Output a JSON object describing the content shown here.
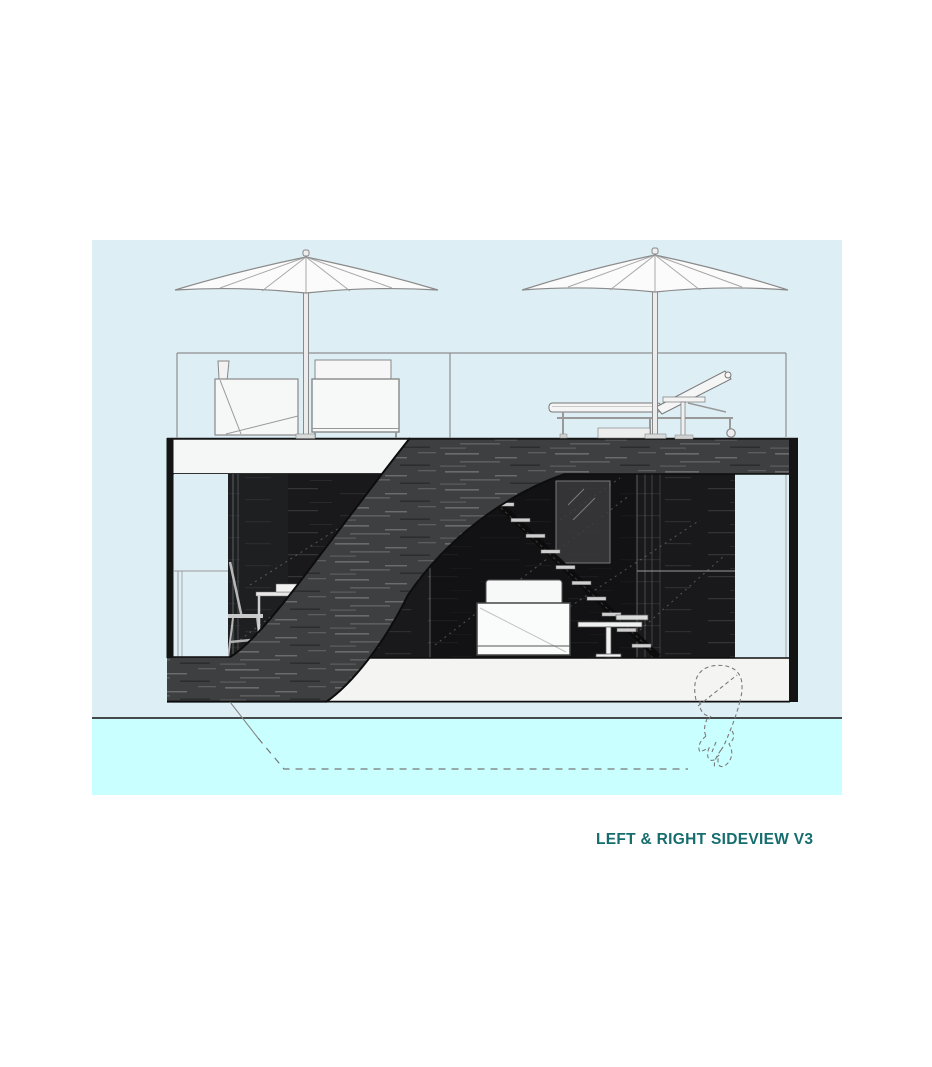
{
  "caption": {
    "text": "LEFT & RIGHT SIDEVIEW V3",
    "color": "#156d6e"
  },
  "scene": {
    "page_background": "#ffffff",
    "sky_color": "#ddeef5",
    "water_color": "#c9ffff",
    "hull_color": "#f4f5f3",
    "deck_slab_color": "#f5f6f6",
    "deck_wood_color": "#3e3f41",
    "wood_streak_color": "#77787b",
    "interior_color": "#19191b",
    "outline_color": "#0d0d0d",
    "thin_line_color": "#8f8f8f",
    "sketch_dash_color": "#7a7a7a",
    "umbrella_count": "2",
    "stair_tread_count": "11"
  }
}
